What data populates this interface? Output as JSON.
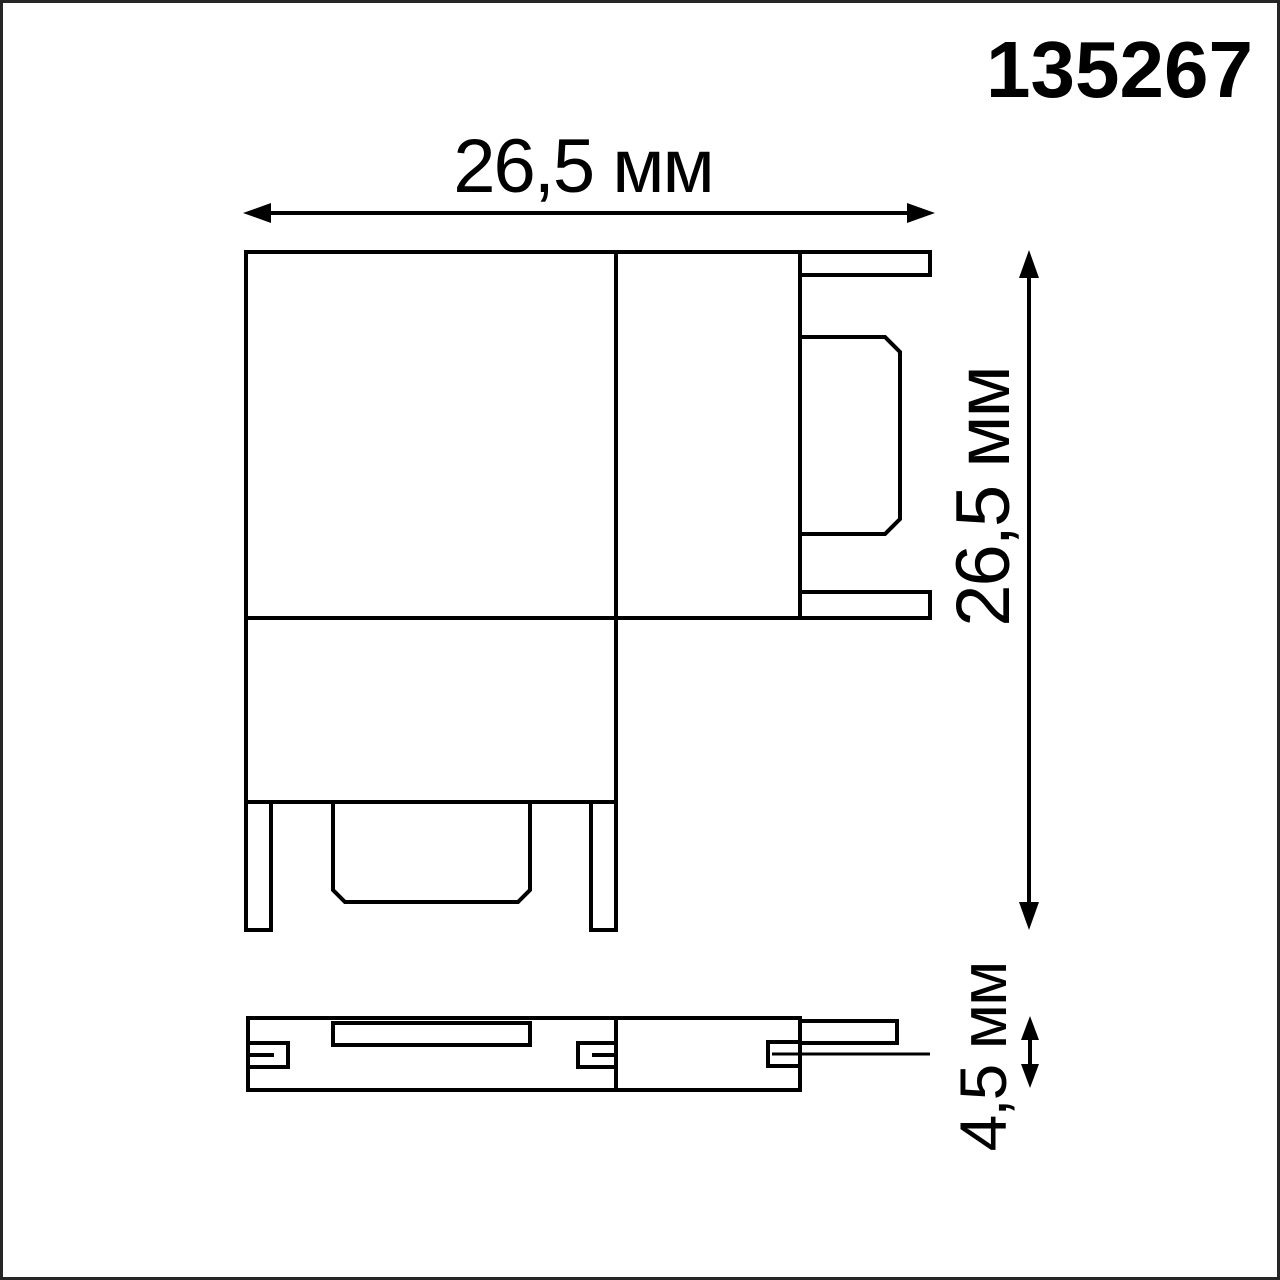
{
  "product": {
    "article_number": "135267"
  },
  "dimensions": {
    "width": "26,5 мм",
    "height": "26,5 мм",
    "thickness": "4,5 мм"
  },
  "drawing": {
    "type": "technical-dimension-drawing",
    "views": [
      "top-view",
      "side-view"
    ],
    "line_color": "#000000",
    "background_color": "#ffffff",
    "frame_color": "#262626"
  }
}
